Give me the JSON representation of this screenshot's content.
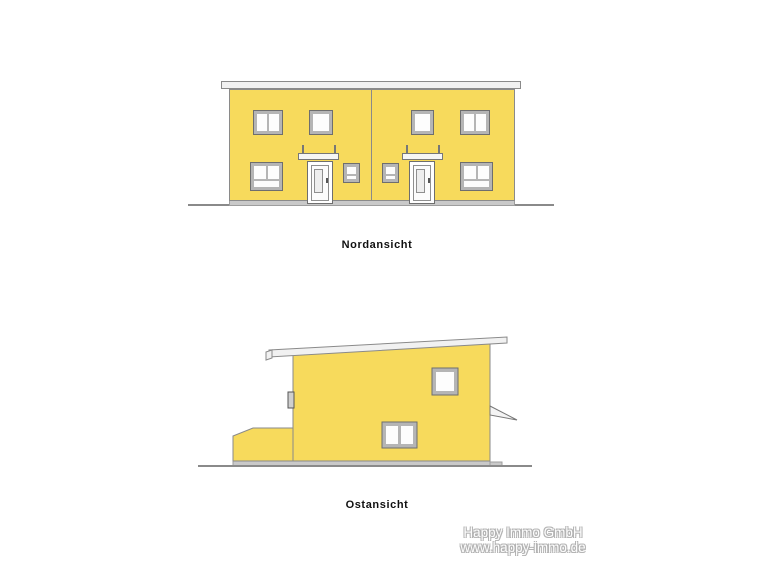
{
  "drawing": {
    "views": [
      {
        "id": "north",
        "label": "Nordansicht"
      },
      {
        "id": "east",
        "label": "Ostansicht"
      }
    ],
    "watermark": {
      "company": "Happy Immo GmbH",
      "website": "www.happy-immo.de"
    },
    "colors": {
      "facade_yellow": "#f7da5c",
      "outline_gray": "#8a8a8a",
      "frame_gray": "#b5b5b5",
      "roof_white": "#f1f1f1",
      "plinth_gray": "#c9c9c9",
      "label_black": "#111111",
      "watermark_gray": "#b3b3b3"
    }
  }
}
